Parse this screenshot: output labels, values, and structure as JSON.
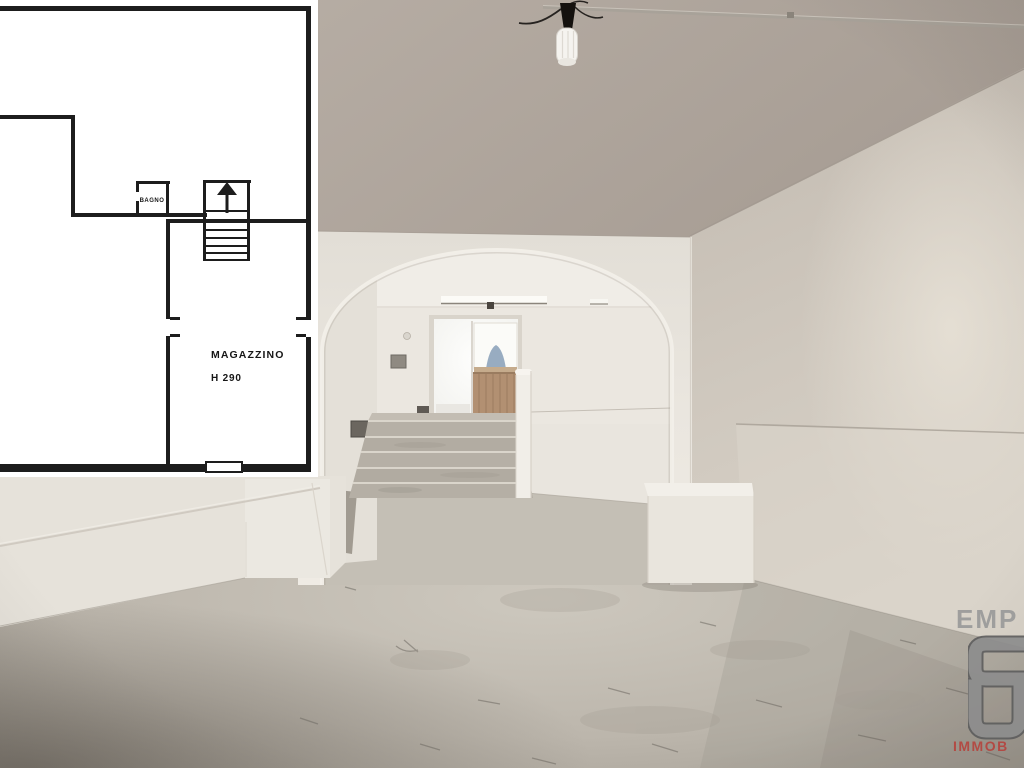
{
  "floorplan": {
    "labels": {
      "bathroom": "BAGNO",
      "storage": "MAGAZZINO",
      "storage_height": "H 290"
    }
  },
  "watermark": {
    "line1": "EMP",
    "line2": "IMMOB"
  },
  "colors": {
    "plan_background": "#ffffff",
    "plan_line": "#1d1d1d",
    "ceiling": "#b2a9a0",
    "wall_white": "#e9e5de",
    "wall_right": "#cac2b8",
    "floor": "#beb8ae",
    "floor_dark": "#8d8980",
    "step_concrete": "#b3ada3",
    "door_wood": "#b29072",
    "daylight_glow": "#fdfdfb",
    "dome_silhouette": "#8099b3",
    "logo_grey": "#8d8d8d",
    "logo_grey_outline": "#5e5e5e",
    "logo_red": "#b5453f"
  }
}
